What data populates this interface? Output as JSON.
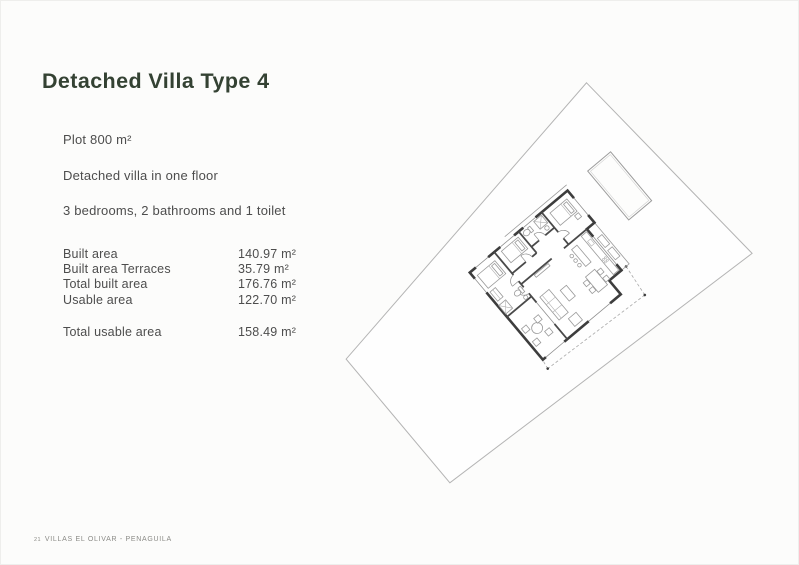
{
  "header": {
    "title": "Detached Villa Type 4"
  },
  "specs": {
    "lines": [
      "Plot 800 m²",
      "Detached villa in one floor",
      "3 bedrooms, 2 bathrooms and 1 toilet"
    ]
  },
  "areas": {
    "rows": [
      {
        "label": "Built area",
        "value": "140.97 m²"
      },
      {
        "label": "Built area Terraces",
        "value": "35.79 m²"
      },
      {
        "label": "Total built area",
        "value": "176.76 m²"
      },
      {
        "label": "Usable area",
        "value": "122.70 m²"
      }
    ],
    "total": {
      "label": "Total usable area",
      "value": "158.49 m²"
    }
  },
  "footer": {
    "page_number": "21",
    "project": "VILLAS EL OLIVAR - PENAGUILA"
  },
  "site_plan": {
    "elements": [
      "plot-boundary",
      "villa-floor-plan",
      "pool",
      "roof-overhang-dashed"
    ]
  },
  "colors": {
    "background": "#fcfcfb",
    "title-text": "#344233",
    "body-text": "#4d4d4d",
    "footer-text": "#8a8a86",
    "plot-line": "#b4b4b4",
    "wall": "#3d3d3d",
    "furniture": "#9a9a9a"
  }
}
